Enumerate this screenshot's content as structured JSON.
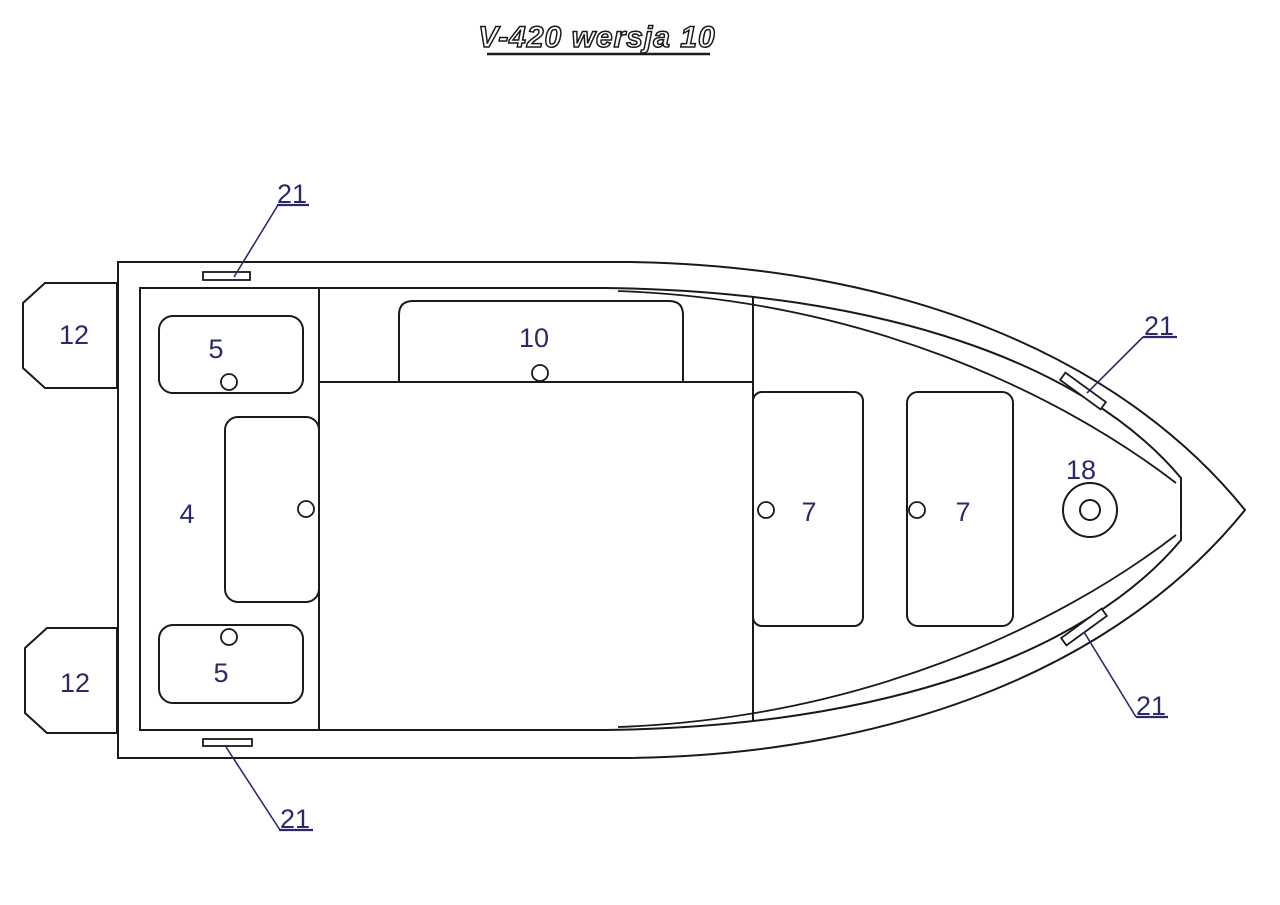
{
  "title": "V-420 wersja 10",
  "drawing_type": "boat top-view technical drawing",
  "colors": {
    "line": "#1a1a1a",
    "label": "#2a2a6a",
    "background": "#ffffff"
  },
  "labels": {
    "bracket_top": "12",
    "bracket_bottom": "12",
    "seat_top": "5",
    "seat_bottom": "5",
    "console": "4",
    "bench_mid": "10",
    "bench_fwd_1": "7",
    "bench_fwd_2": "7",
    "bow_ring": "18",
    "cleat_tl": "21",
    "cleat_tr": "21",
    "cleat_br": "21",
    "cleat_bl": "21"
  }
}
